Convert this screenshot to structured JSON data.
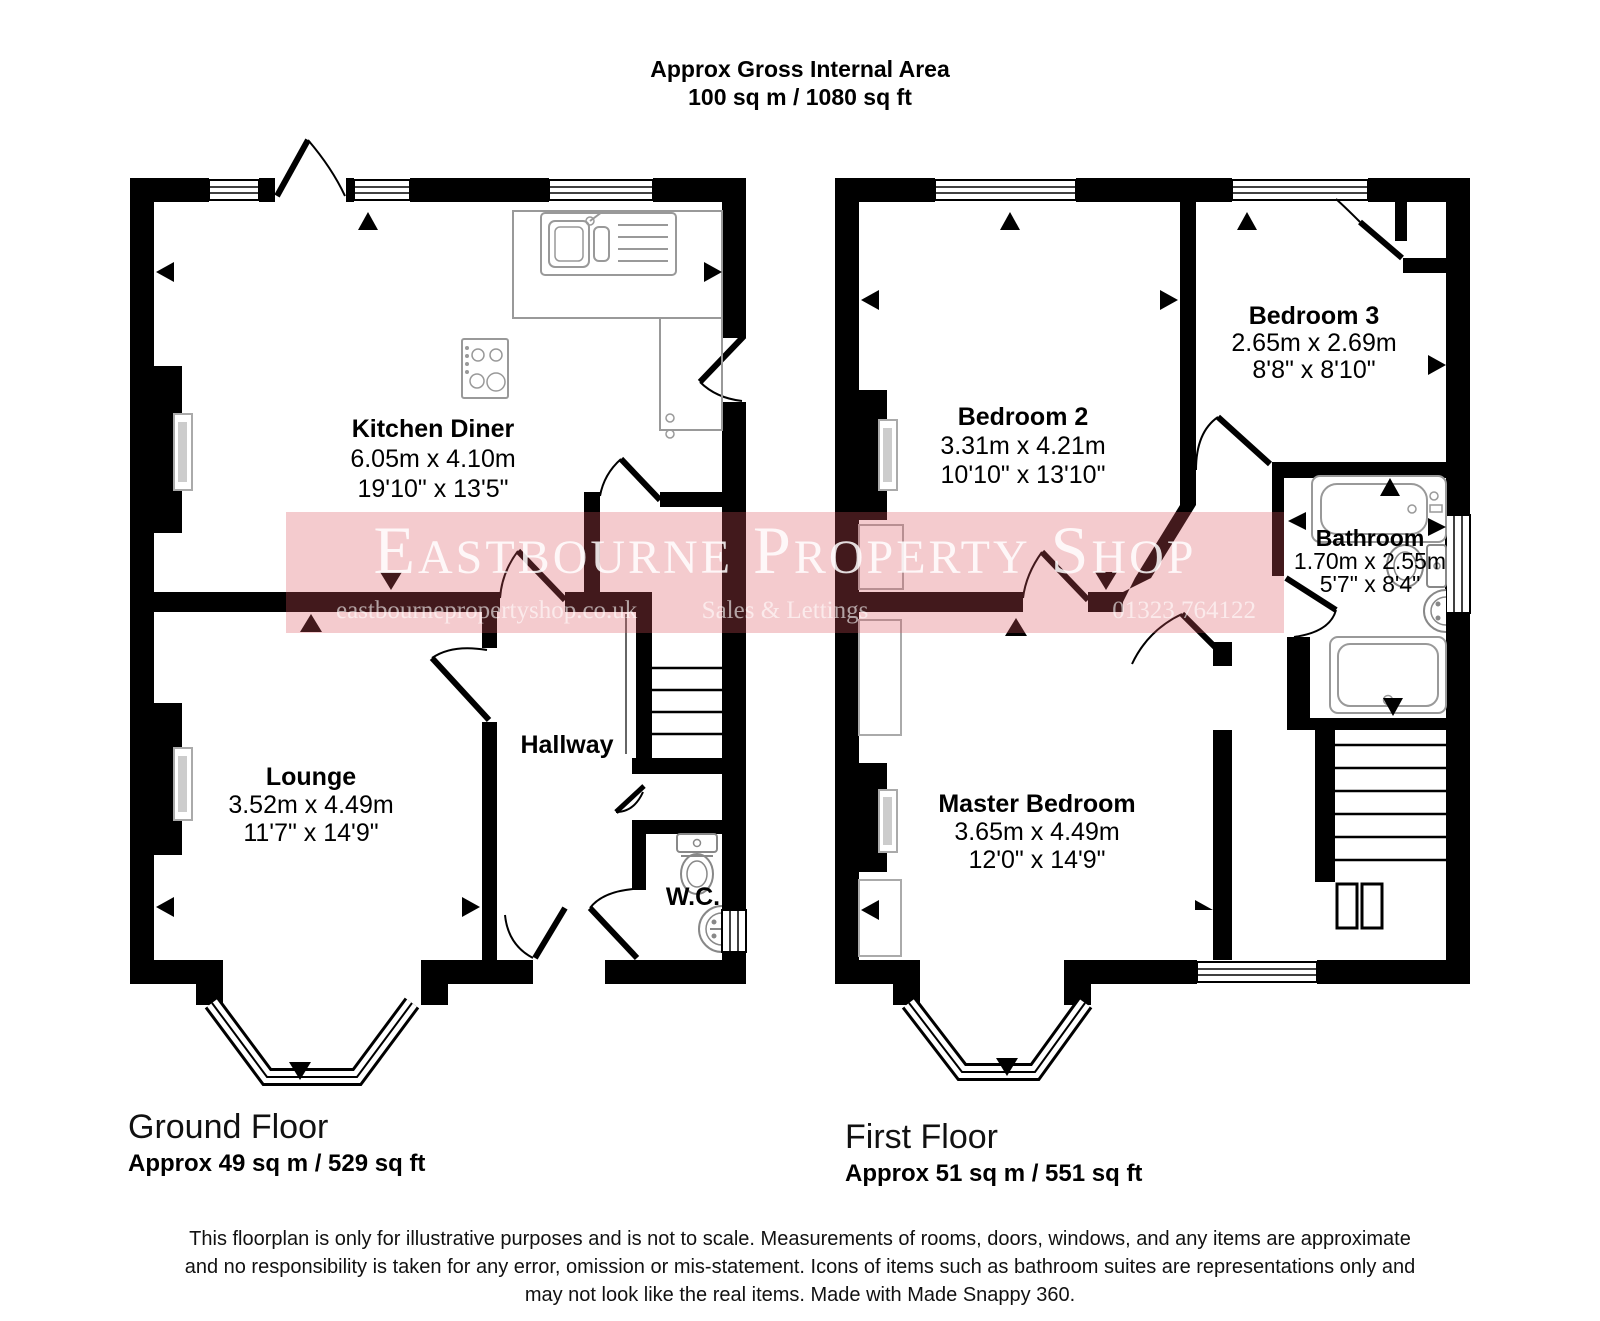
{
  "header": {
    "line1": "Approx Gross Internal Area",
    "line2": "100 sq m / 1080 sq ft"
  },
  "watermark": {
    "brand": "Eastbourne Property Shop",
    "website": "eastbournepropertyshop.co.uk",
    "tagline": "Sales & Lettings",
    "phone": "01323 764122",
    "banner_color": "#e8a7ad",
    "wall_color": "#000000"
  },
  "ground_floor": {
    "label": "Ground Floor",
    "area": "Approx 49 sq m / 529 sq ft",
    "rooms": [
      {
        "name": "Kitchen Diner",
        "metric": "6.05m x 4.10m",
        "imperial": "19'10\" x 13'5\""
      },
      {
        "name": "Lounge",
        "metric": "3.52m x 4.49m",
        "imperial": "11'7\" x 14'9\""
      },
      {
        "name": "Hallway",
        "metric": "",
        "imperial": ""
      },
      {
        "name": "W.C.",
        "metric": "",
        "imperial": ""
      }
    ]
  },
  "first_floor": {
    "label": "First Floor",
    "area": "Approx 51 sq m / 551 sq ft",
    "rooms": [
      {
        "name": "Bedroom 2",
        "metric": "3.31m x 4.21m",
        "imperial": "10'10\" x 13'10\""
      },
      {
        "name": "Bedroom 3",
        "metric": "2.65m x 2.69m",
        "imperial": "8'8\" x 8'10\""
      },
      {
        "name": "Bathroom",
        "metric": "1.70m x 2.55m",
        "imperial": "5'7\" x 8'4\""
      },
      {
        "name": "Master Bedroom",
        "metric": "3.65m x 4.49m",
        "imperial": "12'0\" x 14'9\""
      }
    ]
  },
  "footer": {
    "line1": "This floorplan is only for illustrative purposes and is not to scale. Measurements of rooms, doors, windows, and any items are approximate",
    "line2": "and no responsibility is taken for any error, omission or mis-statement. Icons of items such as bathroom suites are representations only and",
    "line3": "may not look like the real items. Made with Made Snappy 360."
  }
}
